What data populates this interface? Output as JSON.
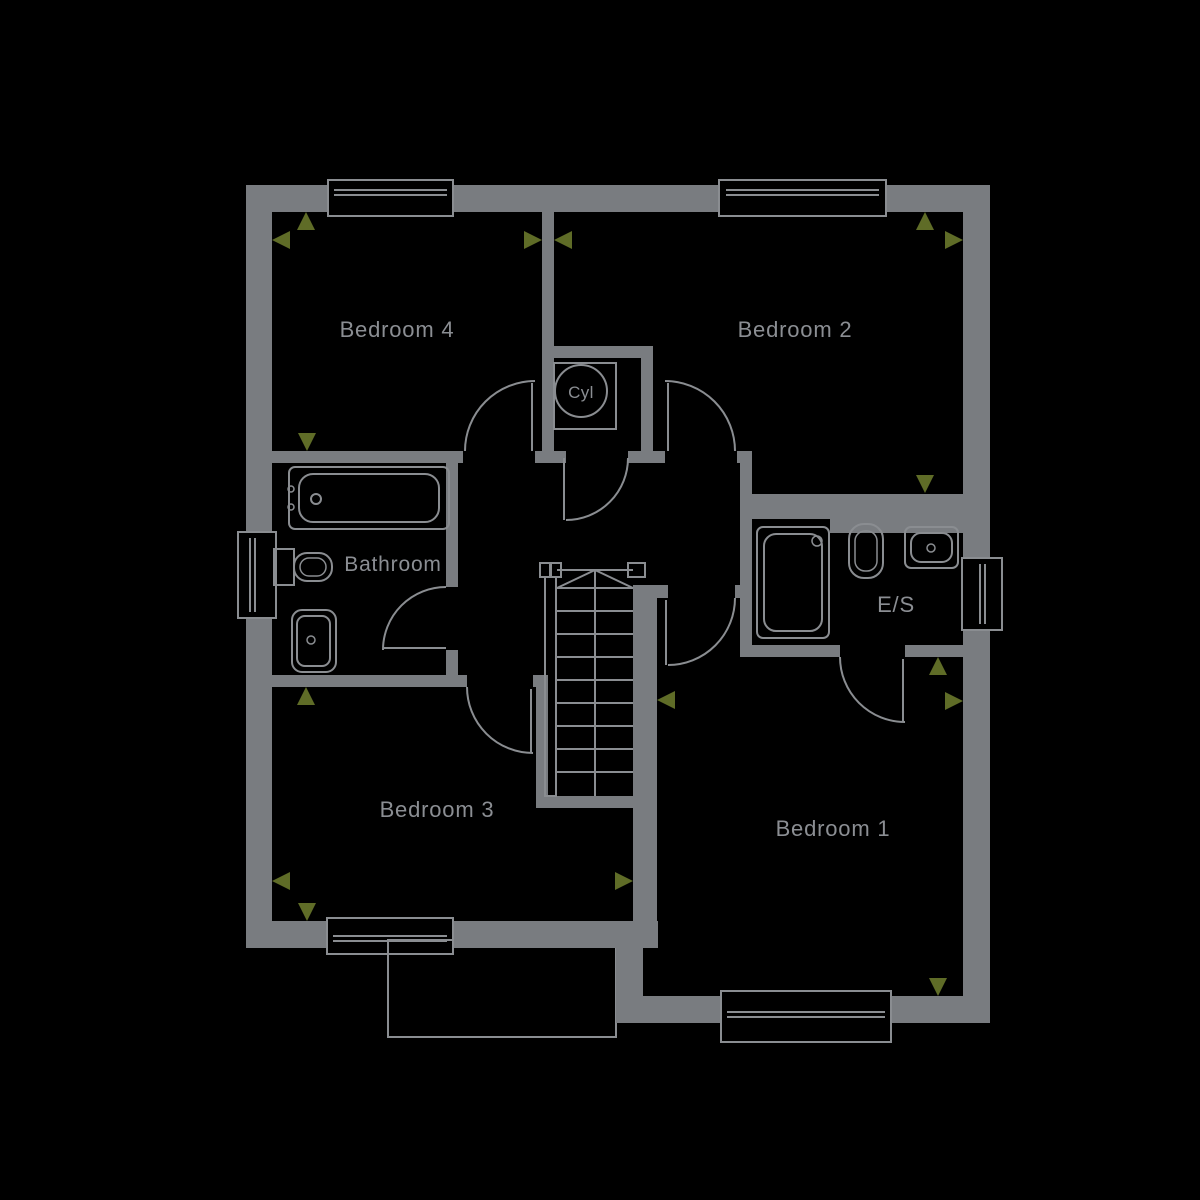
{
  "canvas": {
    "width": 1200,
    "height": 1200
  },
  "colors": {
    "background": "#000000",
    "wall": "#797c80",
    "line": "#8a8d91",
    "label": "#8b8e93",
    "arrow": "#5f6c27"
  },
  "rooms": {
    "bedroom4": {
      "label": "Bedroom 4"
    },
    "bedroom2": {
      "label": "Bedroom 2"
    },
    "bedroom3": {
      "label": "Bedroom 3"
    },
    "bedroom1": {
      "label": "Bedroom 1"
    },
    "bathroom": {
      "label": "Bathroom"
    },
    "ensuite": {
      "label": "E/S"
    },
    "cylinder": {
      "label": "Cyl"
    }
  },
  "fixtures": [
    "bath",
    "bathroom-wc",
    "bathroom-basin",
    "shower",
    "ensuite-wc",
    "ensuite-basin",
    "cylinder-tank",
    "staircase"
  ],
  "windows": [
    "bedroom4-window",
    "bedroom2-window",
    "bathroom-window",
    "ensuite-window",
    "bedroom3-window",
    "bedroom1-window"
  ],
  "doors": [
    "bedroom4-door",
    "bedroom2-door",
    "cylinder-cupboard-door",
    "bathroom-door",
    "bedroom3-door",
    "bedroom1-door",
    "ensuite-door"
  ]
}
